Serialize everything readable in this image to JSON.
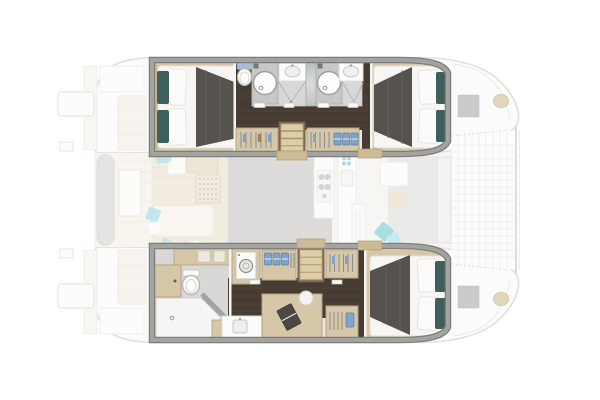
{
  "canvas": {
    "width": 600,
    "height": 400,
    "background": "#ffffff"
  },
  "diagram": {
    "type": "boat-floorplan",
    "subject": "catamaran-interior-layout-top-view",
    "highlighted_part": "hull-accommodations",
    "faded_part": "decks-saloon-cockpits-trampoline",
    "visible_cabins": 3,
    "visible_bathrooms": 3
  },
  "palette": {
    "bg": "#ffffff",
    "wall": "#a3a3a0",
    "wallEdge": "#7e7e7b",
    "wood": "#d6c7a8",
    "woodDark": "#cdbb95",
    "woodTrim": "#b4a383",
    "darkFloor": "#463c33",
    "darkFloorStreak": "#5a4d41",
    "linen": "#f7f6f4",
    "duvet": "#56524d",
    "teal": "#3f5f5d",
    "blue": "#7fa3cb",
    "toiletBlue": "#a4bed4",
    "bathFloor": "#d9d8d6",
    "showerPan": "#c8c7c5",
    "stepWood": "#ddcda9",
    "stepRail": "#8d7557",
    "hatch": "#cbcbc9",
    "pad": "#e5d7bc",
    "cyan": "#8fd4da",
    "fadedLine": "#c8c7c3",
    "fadedDeck": "#fbfbfa",
    "saloonGray": "#c2c1bf",
    "beigeFloor": "#e8dec9",
    "benchGray": "#d0cfcc"
  },
  "regions": {
    "port_hull": {
      "areas": [
        "aft-double-cabin",
        "toilet",
        "shower-room-aft",
        "shower-room-forward",
        "wardrobes-with-hangers",
        "companionway-steps",
        "forward-double-cabin"
      ]
    },
    "starboard_hull": {
      "areas": [
        "aft-head-with-shower",
        "washing-machine-cabinet",
        "vanity-sink",
        "desk-with-laptop",
        "stool",
        "wardrobes-with-hangers",
        "companionway-steps",
        "forward-double-cabin"
      ]
    },
    "saloon_faded": {
      "areas": [
        "galley-counter",
        "stove",
        "sink",
        "island-unit",
        "sofa-chaise",
        "scatter-cushions",
        "vented-cabinet",
        "table"
      ]
    },
    "exterior_faded": {
      "areas": [
        "aft-cockpit-bench",
        "cockpit-table",
        "transom-steps",
        "swim-platforms",
        "foredeck-hatches",
        "mooring-pads",
        "bow-trampoline",
        "forward-crossbeam",
        "forward-cockpit-seating"
      ]
    }
  }
}
